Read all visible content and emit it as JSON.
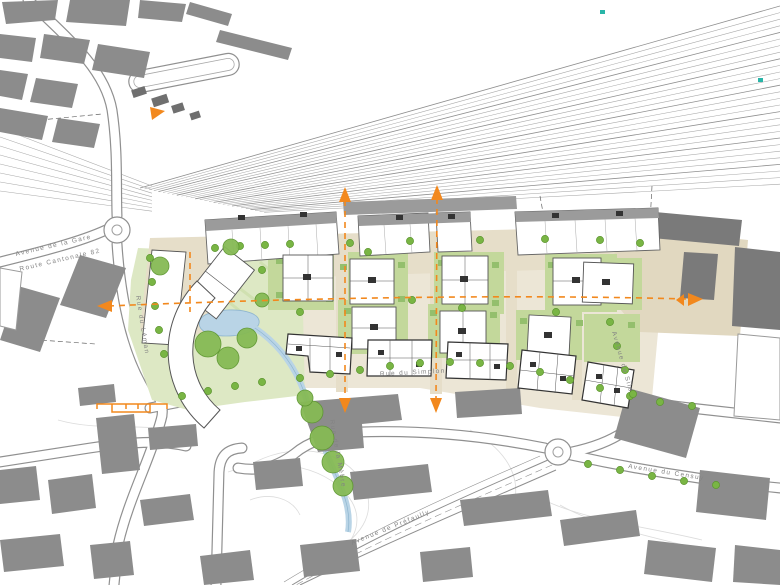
{
  "map": {
    "streets": {
      "simplon": "Rue du Simplon",
      "leman": "Rue du Léman",
      "gare": "Avenue de la Gare",
      "cantonale": "Route Cantonale 82",
      "silo": "Avenue du Silo",
      "censuy": "Avenue du Censuy",
      "prefaully": "Avenue de Préfaully",
      "mebre": "Rue de la Mèbre"
    },
    "colors": {
      "existing_building": "#8c8c8c",
      "silo_building": "#7a7a7a",
      "new_building": "#ffffff",
      "site_ground": "#ece6d6",
      "promenade": "#e6dec9",
      "plaza": "#e1d8c0",
      "lawn": "#dde8c4",
      "courtyard_green": "#c3d89b",
      "hedge": "#94bf6d",
      "tree": "#79b544",
      "tree_edge": "#5d9630",
      "canopy": "#86ba55",
      "water": "#b9d4e6",
      "axis_orange": "#f2881d",
      "track_line": "#a8a8a8",
      "road_casing": "#909090",
      "label_text": "#848484"
    }
  }
}
